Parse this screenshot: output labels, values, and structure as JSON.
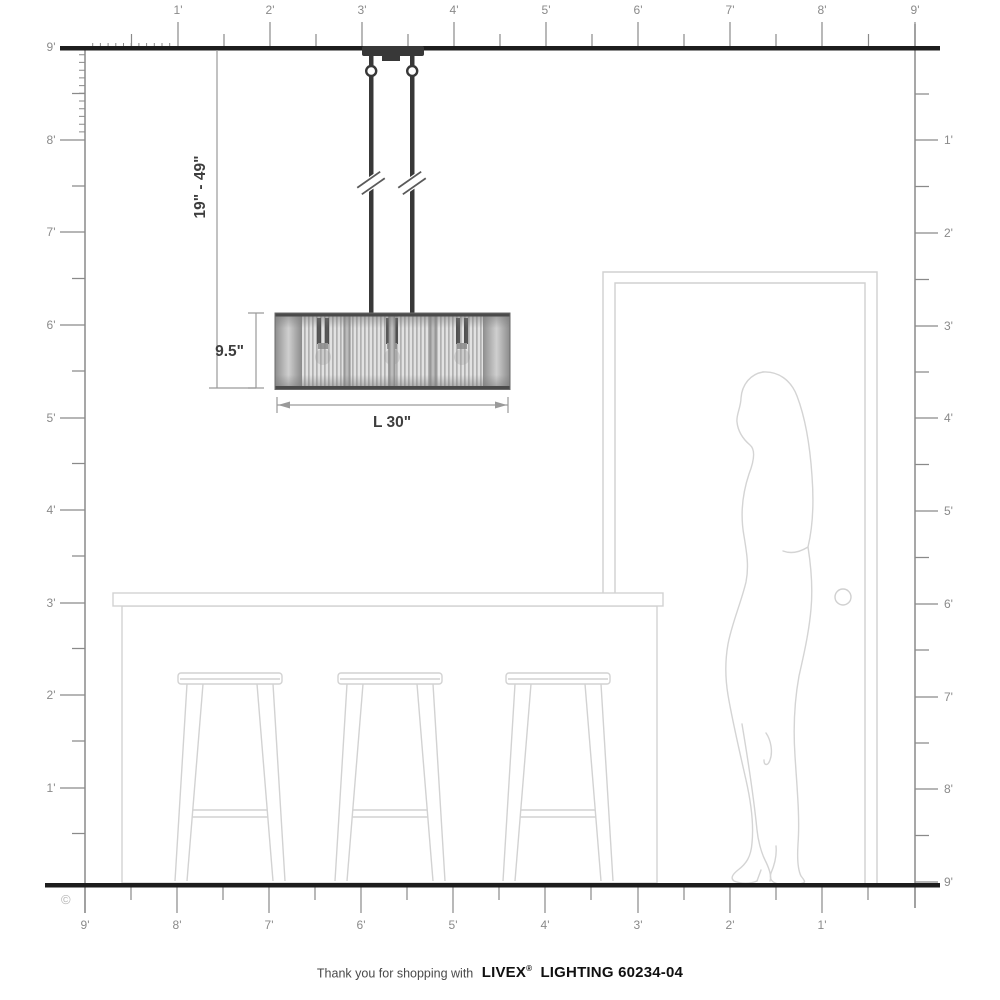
{
  "footer": {
    "prefix": "Thank you for shopping with",
    "brand": "LIVEX",
    "reg": "®",
    "suffix": "LIGHTING 60234-04"
  },
  "annotations": {
    "hang_range": "19\" - 49\"",
    "fixture_height": "9.5\"",
    "fixture_length": "L 30\""
  },
  "copyright": "©",
  "rulers": {
    "top": {
      "labels": [
        "1'",
        "2'",
        "3'",
        "4'",
        "5'",
        "6'",
        "7'",
        "8'",
        "9'"
      ]
    },
    "left": {
      "labels": [
        "9'",
        "8'",
        "7'",
        "6'",
        "5'",
        "4'",
        "3'",
        "2'",
        "1'"
      ]
    },
    "right": {
      "labels": [
        "1'",
        "2'",
        "3'",
        "4'",
        "5'",
        "6'",
        "7'",
        "8'",
        "9'"
      ]
    },
    "bottom": {
      "labels": [
        "9'",
        "8'",
        "7'",
        "6'",
        "5'",
        "4'",
        "3'",
        "2'",
        "1'"
      ]
    }
  },
  "colors": {
    "structure": "#1d1d1d",
    "ruler": "#8a8a8a",
    "ruler_label": "#8a8a8a",
    "dimension_text": "#3e3e3e",
    "furniture_outline": "#d2d2d2",
    "fixture_dark": "#383838"
  }
}
